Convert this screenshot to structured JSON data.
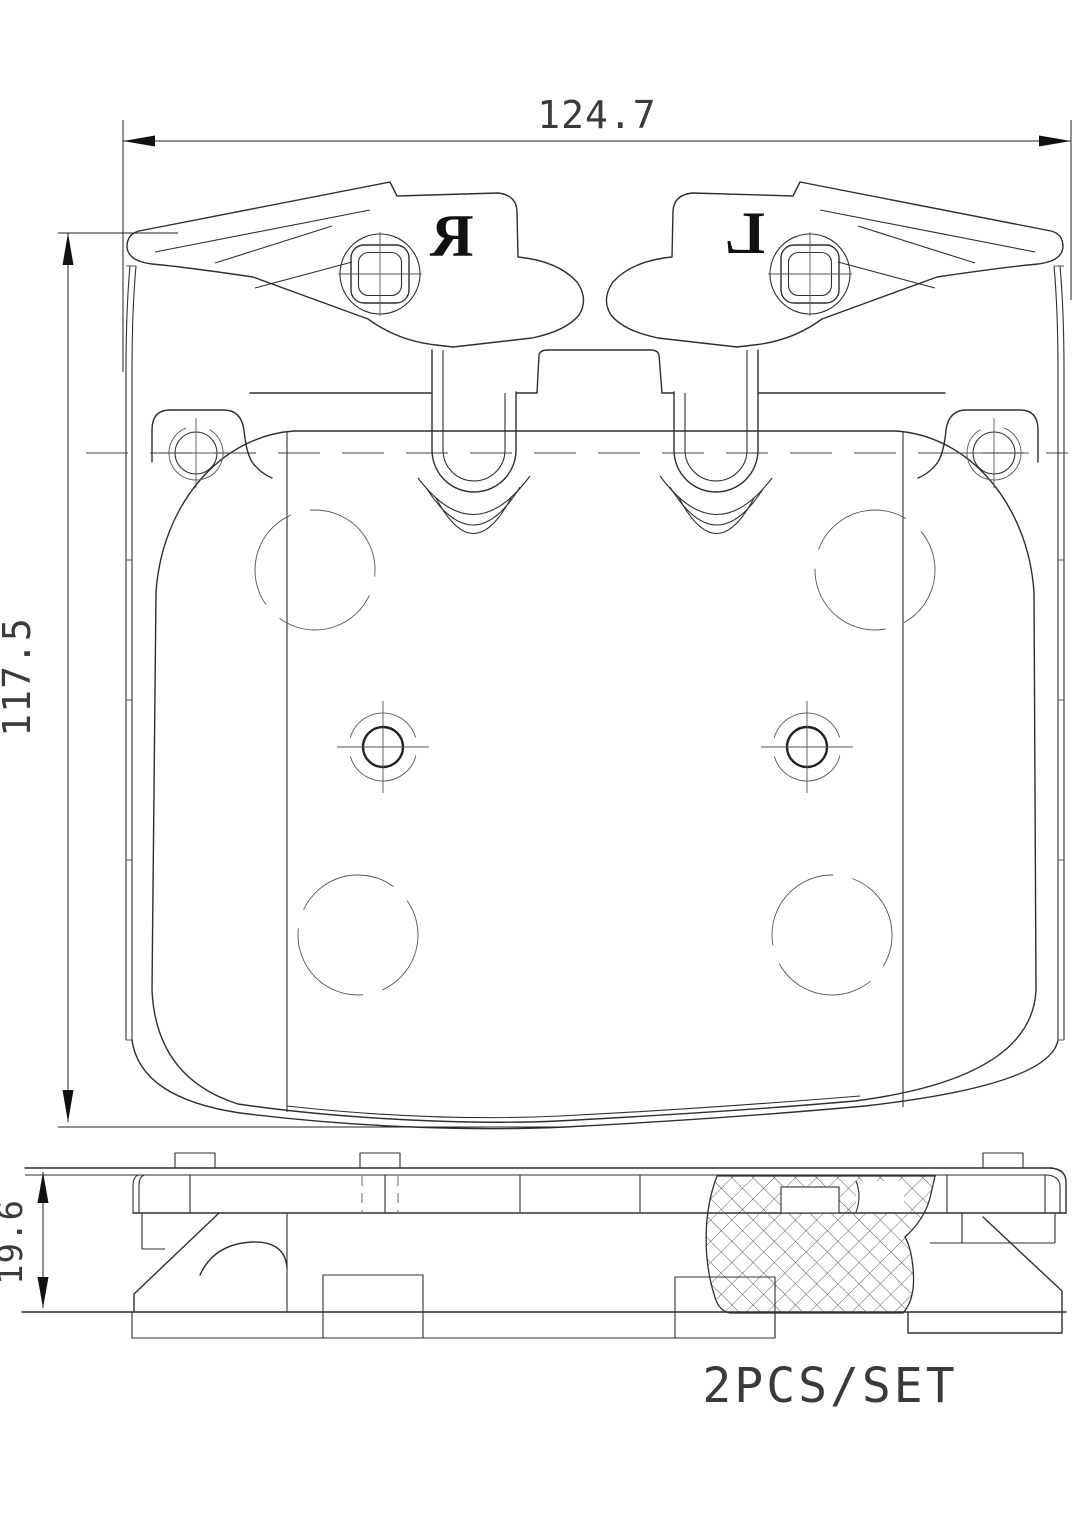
{
  "dimensions": {
    "width": {
      "value": "124.7"
    },
    "height": {
      "value": "117.5"
    },
    "thickness": {
      "value": "19.6"
    }
  },
  "stamps": {
    "right_pad": "R",
    "left_pad": "L"
  },
  "labels": {
    "set_quantity": "2PCS/SET"
  },
  "colors": {
    "background": "#ffffff",
    "line": "#2f2f2f",
    "centerline": "#666666",
    "text": "#3a3a3a",
    "stamp": "#111111"
  }
}
